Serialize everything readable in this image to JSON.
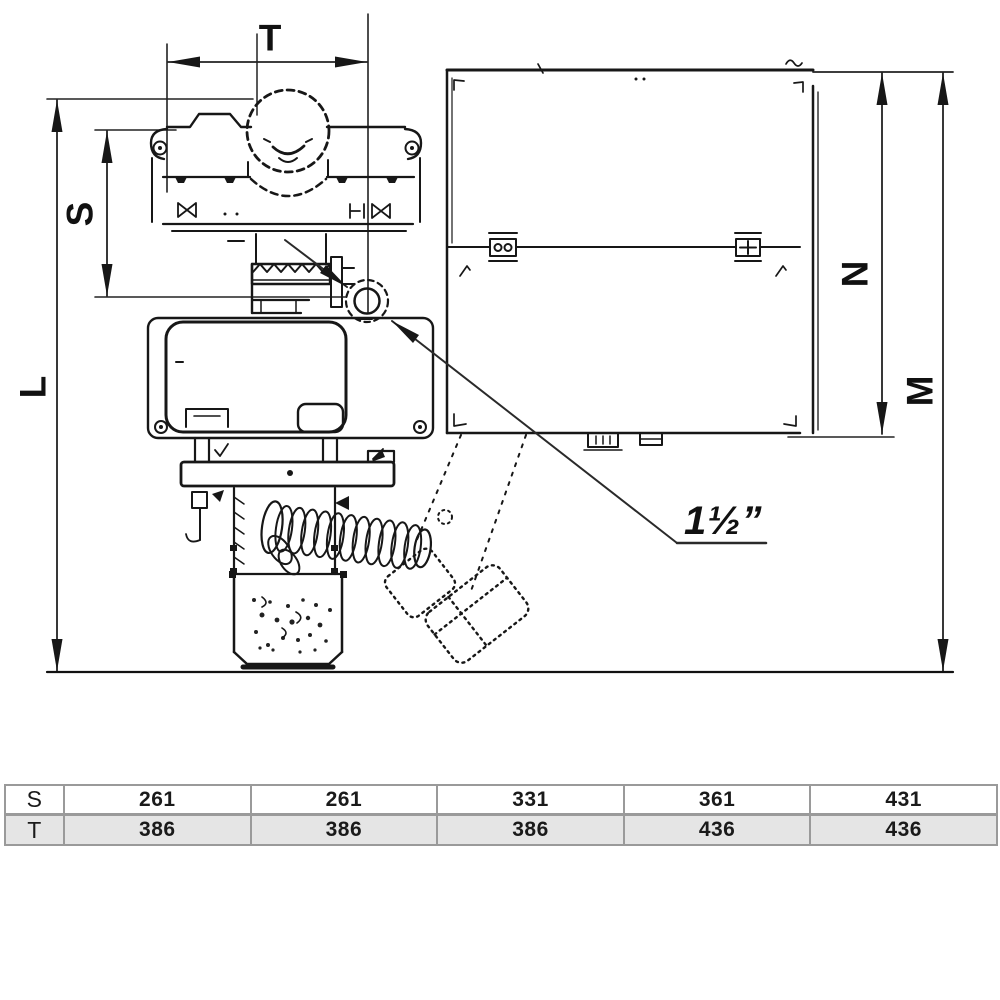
{
  "page": {
    "background": "#ffffff"
  },
  "drawing": {
    "dimensions": {
      "T": "T",
      "S": "S",
      "L": "L",
      "N": "N",
      "M": "M"
    },
    "callout_label": "1½”",
    "colors": {
      "line": "#171717",
      "dim": "#222222",
      "table_border": "#9a9a9a",
      "alt_row_bg": "#e5e5e5"
    }
  },
  "table": {
    "rows": [
      {
        "label": "S",
        "values": [
          "261",
          "261",
          "331",
          "361",
          "431"
        ]
      },
      {
        "label": "T",
        "values": [
          "386",
          "386",
          "386",
          "436",
          "436"
        ]
      }
    ]
  }
}
